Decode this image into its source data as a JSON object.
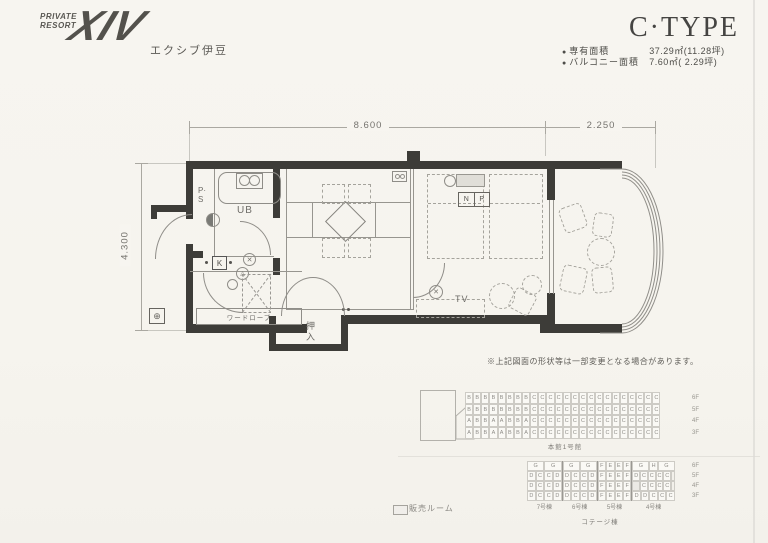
{
  "logo": {
    "private": "PRIVATE",
    "resort": "RESORT",
    "brand": "XIV",
    "subtitle": "エクシブ伊豆"
  },
  "header": {
    "title": "C·TYPE"
  },
  "specs": {
    "rows": [
      {
        "bullet": "●",
        "label": "専有面積",
        "value": "37.29㎡(11.28坪)"
      },
      {
        "bullet": "●",
        "label": "バルコニー面積",
        "value": "7.60㎡( 2.29坪)"
      }
    ]
  },
  "dimensions": {
    "top_main": "8.600",
    "top_balcony": "2.250",
    "left": "4.300"
  },
  "plan": {
    "ps": "P·S",
    "ub": "UB",
    "k": "K",
    "wardrobe": "ワードローブ",
    "oshiire": "押入",
    "tv": "TV",
    "n": "N",
    "p": "P",
    "note": "※上記図面の形状等は一部変更となる場合があります。"
  },
  "icons": {
    "circle_plus": "⊕",
    "cross": "✕",
    "triangle": "△"
  },
  "buildings": {
    "main": {
      "label": "本館1号館",
      "floors": [
        "6F",
        "5F",
        "4F",
        "3F"
      ],
      "rows": [
        "BBBBBBBBCCCCCCCCCCCCCCCC",
        "BBBBBBBBCCCCCCCCCCCCCCCC",
        "ABBAABBACCCCCCCCCCCCCCCC",
        "ABBAABBACCCCCCCCCCCCCCCC"
      ]
    },
    "cottage": {
      "label": "コテージ棟",
      "floors": [
        "6F",
        "5F",
        "4F",
        "3F"
      ],
      "sections": [
        {
          "name": "7号棟",
          "cols": 4,
          "top": [
            {
              "t": "G",
              "span": 2
            },
            {
              "t": "G",
              "span": 2
            }
          ],
          "rows": [
            [
              "D",
              "C",
              "C",
              "D"
            ],
            [
              "D",
              "C",
              "C",
              "D"
            ],
            [
              "D",
              "C",
              "C",
              "D"
            ]
          ]
        },
        {
          "name": "6号棟",
          "cols": 4,
          "top": [
            {
              "t": "G",
              "span": 2
            },
            {
              "t": "G",
              "span": 2
            }
          ],
          "rows": [
            [
              "D",
              "C",
              "C",
              "D"
            ],
            [
              "D",
              "C",
              "C",
              "D"
            ],
            [
              "D",
              "C",
              "C",
              "D"
            ]
          ]
        },
        {
          "name": "5号棟",
          "cols": 4,
          "top": [
            {
              "t": "F",
              "span": 1
            },
            {
              "t": "E",
              "span": 1
            },
            {
              "t": "E",
              "span": 1
            },
            {
              "t": "F",
              "span": 1
            }
          ],
          "rows": [
            [
              "F",
              "E",
              "E",
              "F"
            ],
            [
              "F",
              "E",
              "E",
              "F"
            ],
            [
              "F",
              "E",
              "E",
              "F"
            ]
          ]
        },
        {
          "name": "4号棟",
          "cols": 5,
          "top": [
            {
              "t": "G",
              "span": 2
            },
            {
              "t": "H",
              "span": 1
            },
            {
              "t": "G",
              "span": 2
            }
          ],
          "rows": [
            [
              "D",
              "C",
              "C",
              "C",
              "C"
            ],
            [
              "",
              "C",
              "C",
              "C",
              "C"
            ],
            [
              "D",
              "D",
              "C",
              "C",
              "C"
            ]
          ],
          "narrow_after_rows": [
            1,
            2
          ]
        }
      ]
    }
  },
  "legend": {
    "label": "販売ルーム"
  }
}
